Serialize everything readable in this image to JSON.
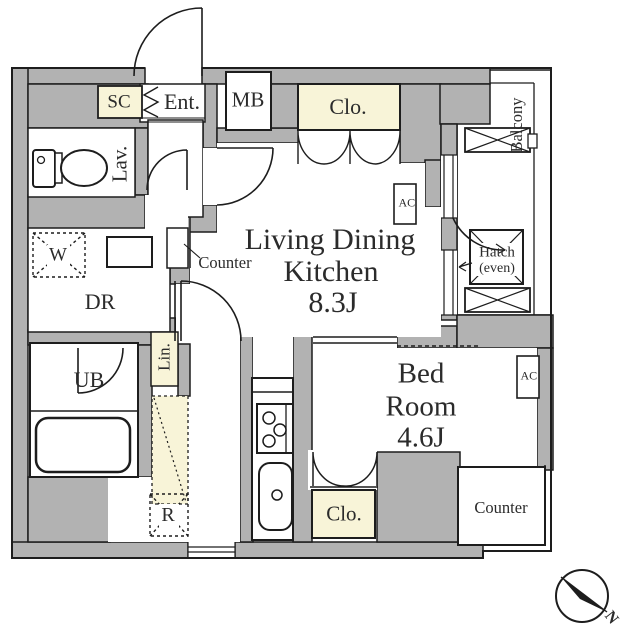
{
  "colors": {
    "wall": "#b2b2b2",
    "closet_fill": "#f8f4d8",
    "line": "#1d1d1d",
    "background": "#ffffff"
  },
  "labels": {
    "sc": "SC",
    "ent": "Ent.",
    "mb": "MB",
    "clo_top": "Clo.",
    "balcony": "Balcony",
    "lav": "Lav.",
    "w": "W",
    "dr": "DR",
    "counter_ldk": "Counter",
    "ldk": [
      "Living Dining",
      "Kitchen",
      "8.3J"
    ],
    "ac": "AC",
    "hatch": [
      "Hatch",
      "(even)"
    ],
    "ub": "UB",
    "lin": "Lin.",
    "r": "R",
    "bedroom": [
      "Bed",
      "Room",
      "4.6J"
    ],
    "clo_bed": "Clo.",
    "counter_bed": "Counter",
    "compass_n": "N"
  },
  "rooms": [
    {
      "name": "Living Dining Kitchen",
      "size": "8.3J"
    },
    {
      "name": "Bed Room",
      "size": "4.6J"
    }
  ]
}
